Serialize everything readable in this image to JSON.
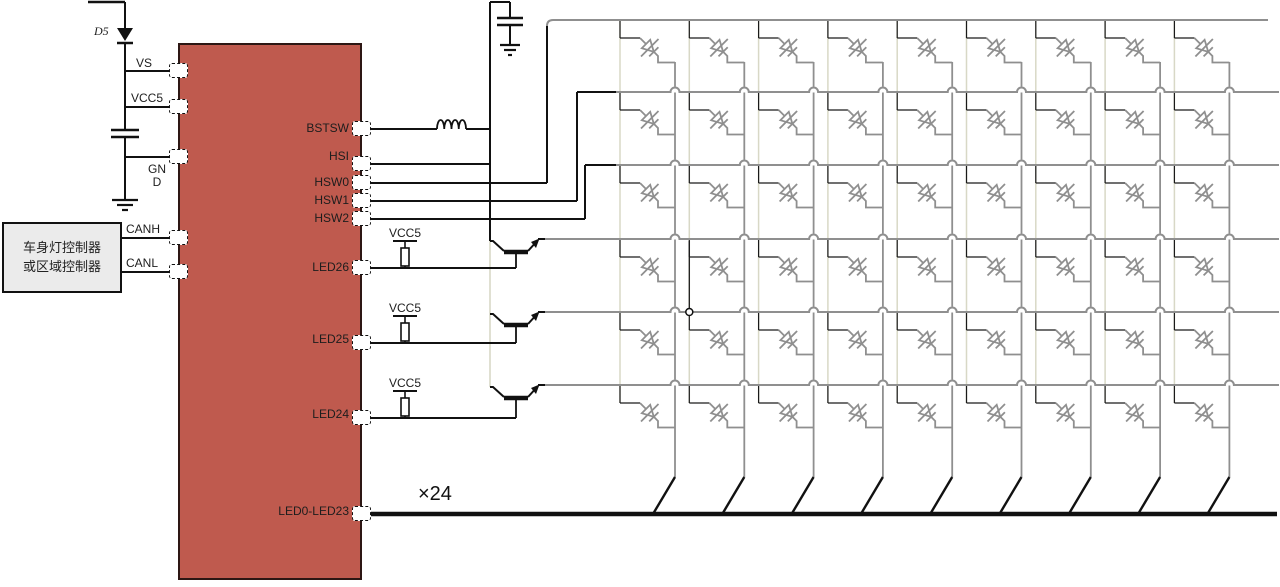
{
  "ic": {
    "pins_left": [
      {
        "label": "VS"
      },
      {
        "label": "VCC5"
      },
      {
        "label": "GND"
      },
      {
        "label": "CANH"
      },
      {
        "label": "CANL"
      }
    ],
    "pins_right": [
      {
        "label": "BSTSW"
      },
      {
        "label": "HSI"
      },
      {
        "label": "HSW0"
      },
      {
        "label": "HSW1"
      },
      {
        "label": "HSW2"
      },
      {
        "label": "LED26"
      },
      {
        "label": "LED25"
      },
      {
        "label": "LED24"
      },
      {
        "label": "LED0-LED23"
      }
    ]
  },
  "controller_box": {
    "line1": "车身灯控制器",
    "line2": "或区域控制器"
  },
  "labels": {
    "diode": "D5",
    "supply": "VCC5",
    "bus_multiplier": "×24"
  },
  "matrix": {
    "columns": 9,
    "rows": 6
  },
  "colors": {
    "ic_fill": "#bf5a4e",
    "ic_border": "#2d1714",
    "wire": "#111111",
    "matrix_gray": "#8f8f8f",
    "matrix_pale": "#d8d8c6",
    "box_fill": "#ebebeb"
  }
}
